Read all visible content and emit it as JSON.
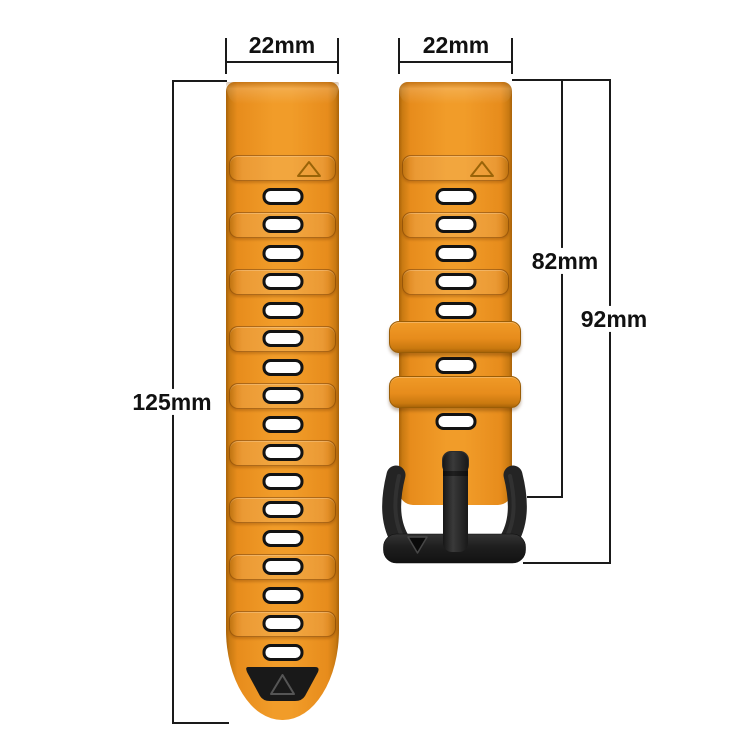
{
  "diagram": {
    "background": "#ffffff",
    "labels": {
      "left_strap_width": "22mm",
      "right_strap_width": "22mm",
      "left_strap_length": "125mm",
      "right_strap_length_to_buckle": "82mm",
      "right_strap_length_total": "92mm"
    },
    "colors": {
      "strap_orange": "#ED921F",
      "strap_orange_light": "#F19C29",
      "strap_orange_dark": "#B36A0E",
      "hardware_black": "#1C1C1C",
      "hole_fill": "#FFFFFF",
      "hole_border": "#131313",
      "dimension_line": "#1A1A1A",
      "text": "#111111"
    },
    "left_strap": {
      "hole_count": 17,
      "raised_plate_count": 8,
      "triangle_marker": "up-triangle-outline",
      "tip": "black-inlay-with-triangle"
    },
    "right_strap": {
      "top_hole_count": 5,
      "extra_hole_count": 2,
      "hole_count": 7,
      "raised_plate_count": 2,
      "keeper_count": 2,
      "triangle_marker": "up-triangle-outline",
      "buckle": "black-pin-buckle",
      "buckle_marker": "down-triangle"
    }
  }
}
